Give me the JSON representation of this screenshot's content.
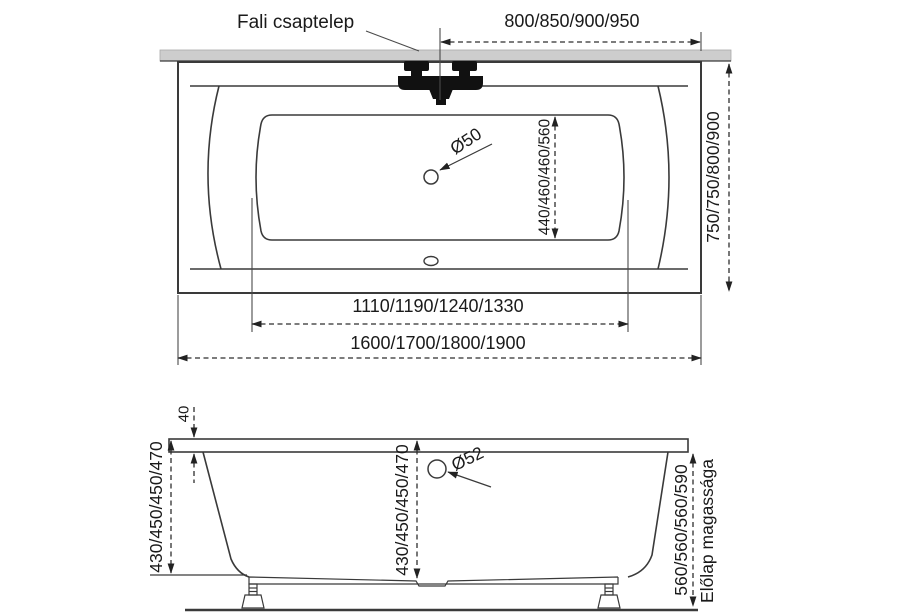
{
  "labels": {
    "wall_faucet": "Fali csaptelep",
    "front_panel_height": "Előlap magassága"
  },
  "top_view": {
    "faucet_distance": "800/850/900/950",
    "outer_width": "750/750/800/900",
    "drain_diameter": "Ø50",
    "drain_distance": "440/460/460/560",
    "inner_length": "1110/1190/1240/1330",
    "outer_length": "1600/1700/1800/1900"
  },
  "side_view": {
    "rim_height": "40",
    "depth_left": "430/450/450/470",
    "depth_center": "430/450/450/470",
    "overflow_diameter": "Ø52",
    "panel_height_values": "560/560/560/590"
  },
  "colors": {
    "line": "#3a3a3a",
    "text": "#1a1a1a",
    "wall_strip": "#cdcdcd",
    "faucet": "#111111"
  }
}
